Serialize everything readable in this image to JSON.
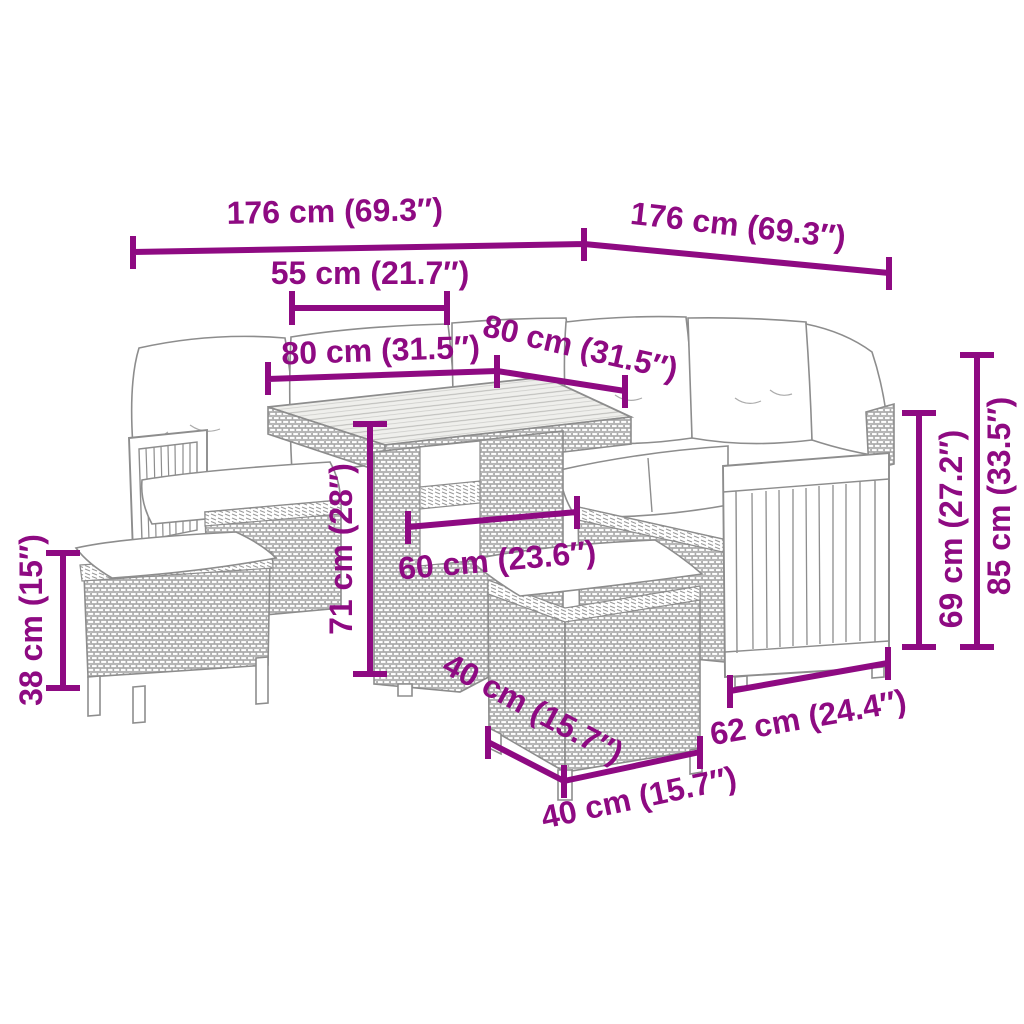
{
  "diagram": {
    "type": "product-dimension-diagram",
    "subject": "poly-rattan-corner-sofa-set-with-table-and-two-stools",
    "background_color": "#ffffff",
    "accent_color": "#8e0a82",
    "line_art_color": "#8d8d8d",
    "dimensions": [
      {
        "name": "sofa-left-total-width",
        "label": "176 cm (69.3″)"
      },
      {
        "name": "sofa-right-total-width",
        "label": "176 cm (69.3″)"
      },
      {
        "name": "backrest-section-width",
        "label": "55 cm (21.7″)"
      },
      {
        "name": "seat-width-left",
        "label": "80 cm (31.5″)"
      },
      {
        "name": "seat-width-right",
        "label": "80 cm (31.5″)"
      },
      {
        "name": "table-height",
        "label": "71 cm (28″)"
      },
      {
        "name": "table-top-width",
        "label": "60 cm (23.6″)"
      },
      {
        "name": "stool-height",
        "label": "38 cm (15″)"
      },
      {
        "name": "armrest-height",
        "label": "69 cm (27.2″)"
      },
      {
        "name": "backrest-height",
        "label": "85 cm (33.5″)"
      },
      {
        "name": "side-panel-width",
        "label": "62 cm (24.4″)"
      },
      {
        "name": "stool-depth",
        "label": "40 cm (15.7″)"
      },
      {
        "name": "stool-width",
        "label": "40 cm (15.7″)"
      }
    ],
    "furniture_parts": [
      "left-sofa-section",
      "right-sofa-section",
      "dining-table",
      "stool-left",
      "stool-right",
      "back-cushions",
      "seat-cushions",
      "wooden-armrest-left",
      "wooden-side-panel-right"
    ]
  }
}
